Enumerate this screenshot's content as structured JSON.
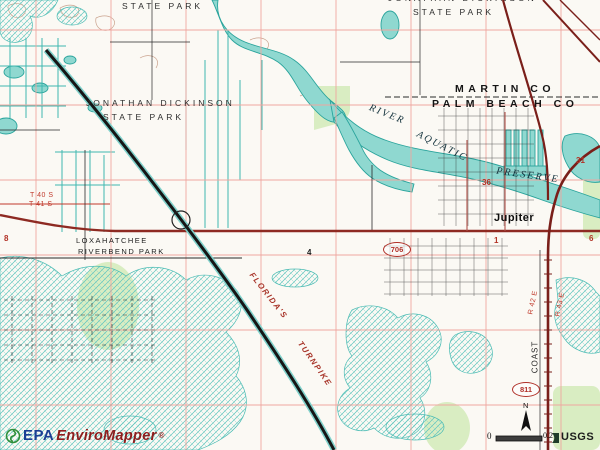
{
  "branding": {
    "epa": "EPA",
    "product": "EnviroMapper",
    "registered": "®"
  },
  "attribution": {
    "usgs": "USGS"
  },
  "scale_bar": {
    "left": "0",
    "right": "0.2"
  },
  "compass": {
    "north": "N"
  },
  "map_labels": {
    "state_park_nw": "STATE PARK",
    "jonathan_dickinson_top": "JONATHAN DICKINSON",
    "state_park_ne": "STATE PARK",
    "jonathan_dickinson": "JONATHAN DICKINSON",
    "state_park_w": "STATE PARK",
    "martin_co": "MARTIN CO",
    "palm_beach_co": "PALM BEACH CO",
    "river": "RIVER",
    "aquatic": "AQUATIC",
    "preserve": "PRESERVE",
    "jupiter": "Jupiter",
    "loxahatchee": "LOXAHATCHEE",
    "riverbend_park": "RIVERBEND PARK",
    "floridas": "FLORIDA'S",
    "turnpike": "TURNPIKE",
    "coast": "COAST",
    "t40s": "T 40 S",
    "t41s": "T 41 S",
    "r42e": "R 42 E",
    "r43e": "R 43 E"
  },
  "section_numbers": {
    "s36": "36",
    "s31": "31",
    "s1": "1",
    "s6": "6",
    "s4": "4",
    "s8": "8"
  },
  "route_shields": {
    "sr706": "706",
    "sr811": "811"
  },
  "colors": {
    "water": "#8fd8d0",
    "water_outline": "#2aa49c",
    "vegetation": "#d9edc2",
    "grid_pink": "#efa6a0",
    "road_red": "#8e2a22",
    "road_dark_maroon": "#7a1f1a",
    "turnpike_black": "#161616",
    "epa_blue": "#1b3f94",
    "enviromapper_red": "#8e1d1d",
    "logo_green": "#2f8f3a"
  }
}
